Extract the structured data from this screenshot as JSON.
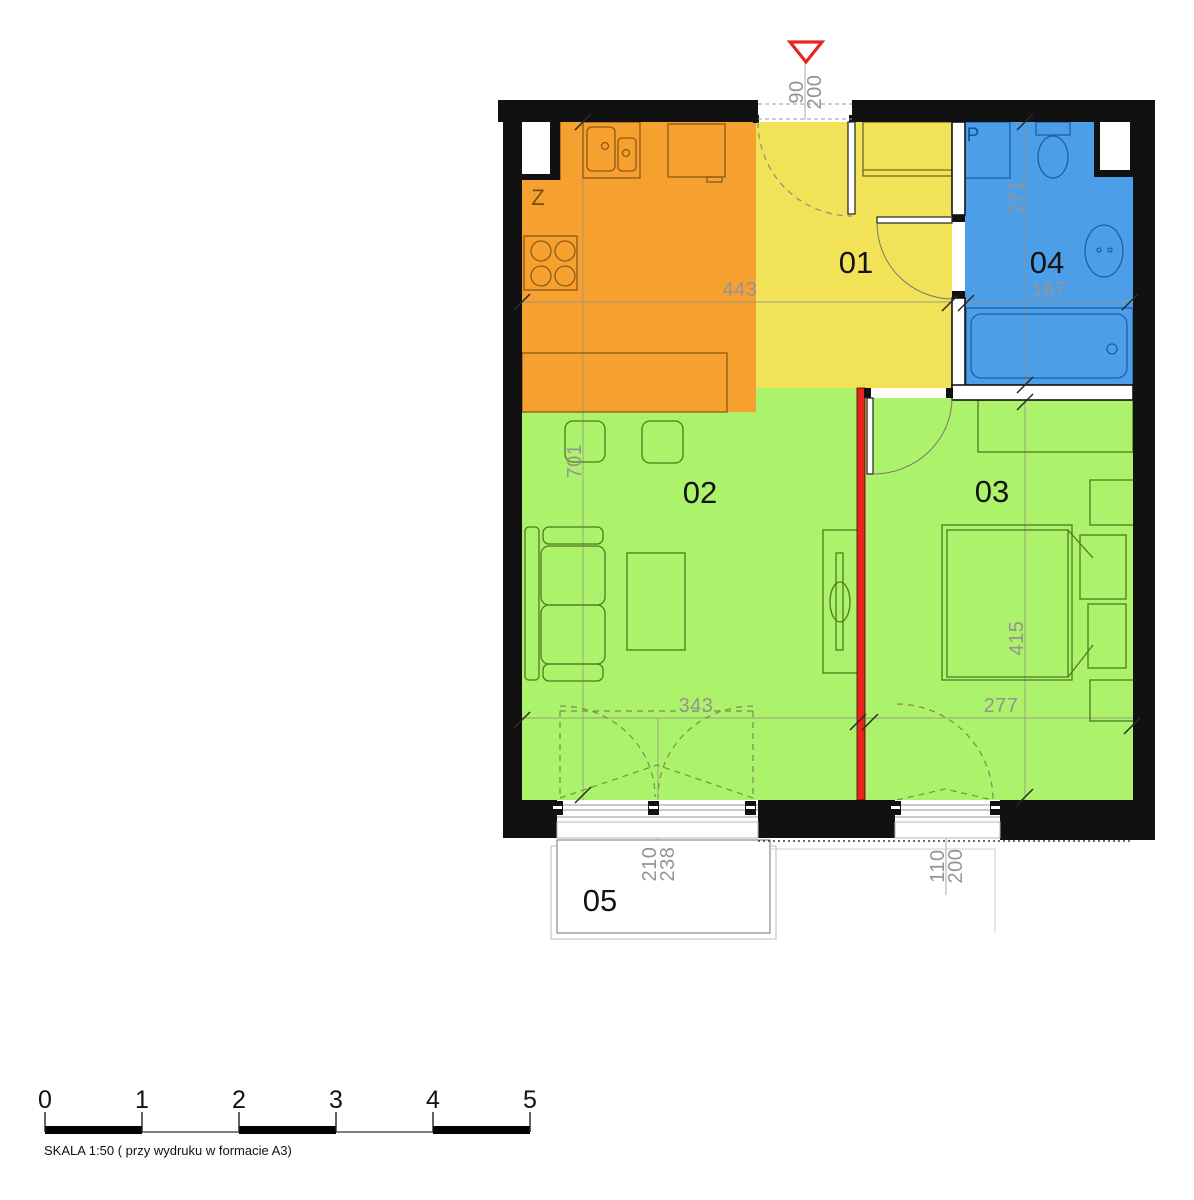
{
  "room_labels": {
    "r01": "01",
    "r02": "02",
    "r03": "03",
    "r04": "04",
    "r05": "05"
  },
  "fixture_labels": {
    "shaft": "Z",
    "washer": "P"
  },
  "dimensions": {
    "entry_width": "90",
    "entry_height": "200",
    "kitchen_hall_width": "443",
    "bathroom_depth": "271",
    "bathroom_width": "167",
    "living_depth": "701",
    "living_width": "343",
    "bedroom_width": "277",
    "bedroom_depth": "415",
    "balcony_door_width": "210",
    "balcony_door_height": "238",
    "bedroom_window_width": "110",
    "bedroom_window_height": "200"
  },
  "scale_bar": {
    "ticks": [
      "0",
      "1",
      "2",
      "3",
      "4",
      "5"
    ],
    "caption": "SKALA 1:50 ( przy wydruku w formacie A3)"
  },
  "colors": {
    "wall": "#111111",
    "kitchen": "#F6A02F",
    "hall": "#F2E258",
    "living_room": "#ACF26A",
    "bathroom": "#4D9EE9",
    "new_wall_red": "#E9241F",
    "entry_arrow": "#E9241F",
    "balcony": "#FFFFFF",
    "dimension_text": "#949494",
    "room_number_text": "#141414"
  }
}
